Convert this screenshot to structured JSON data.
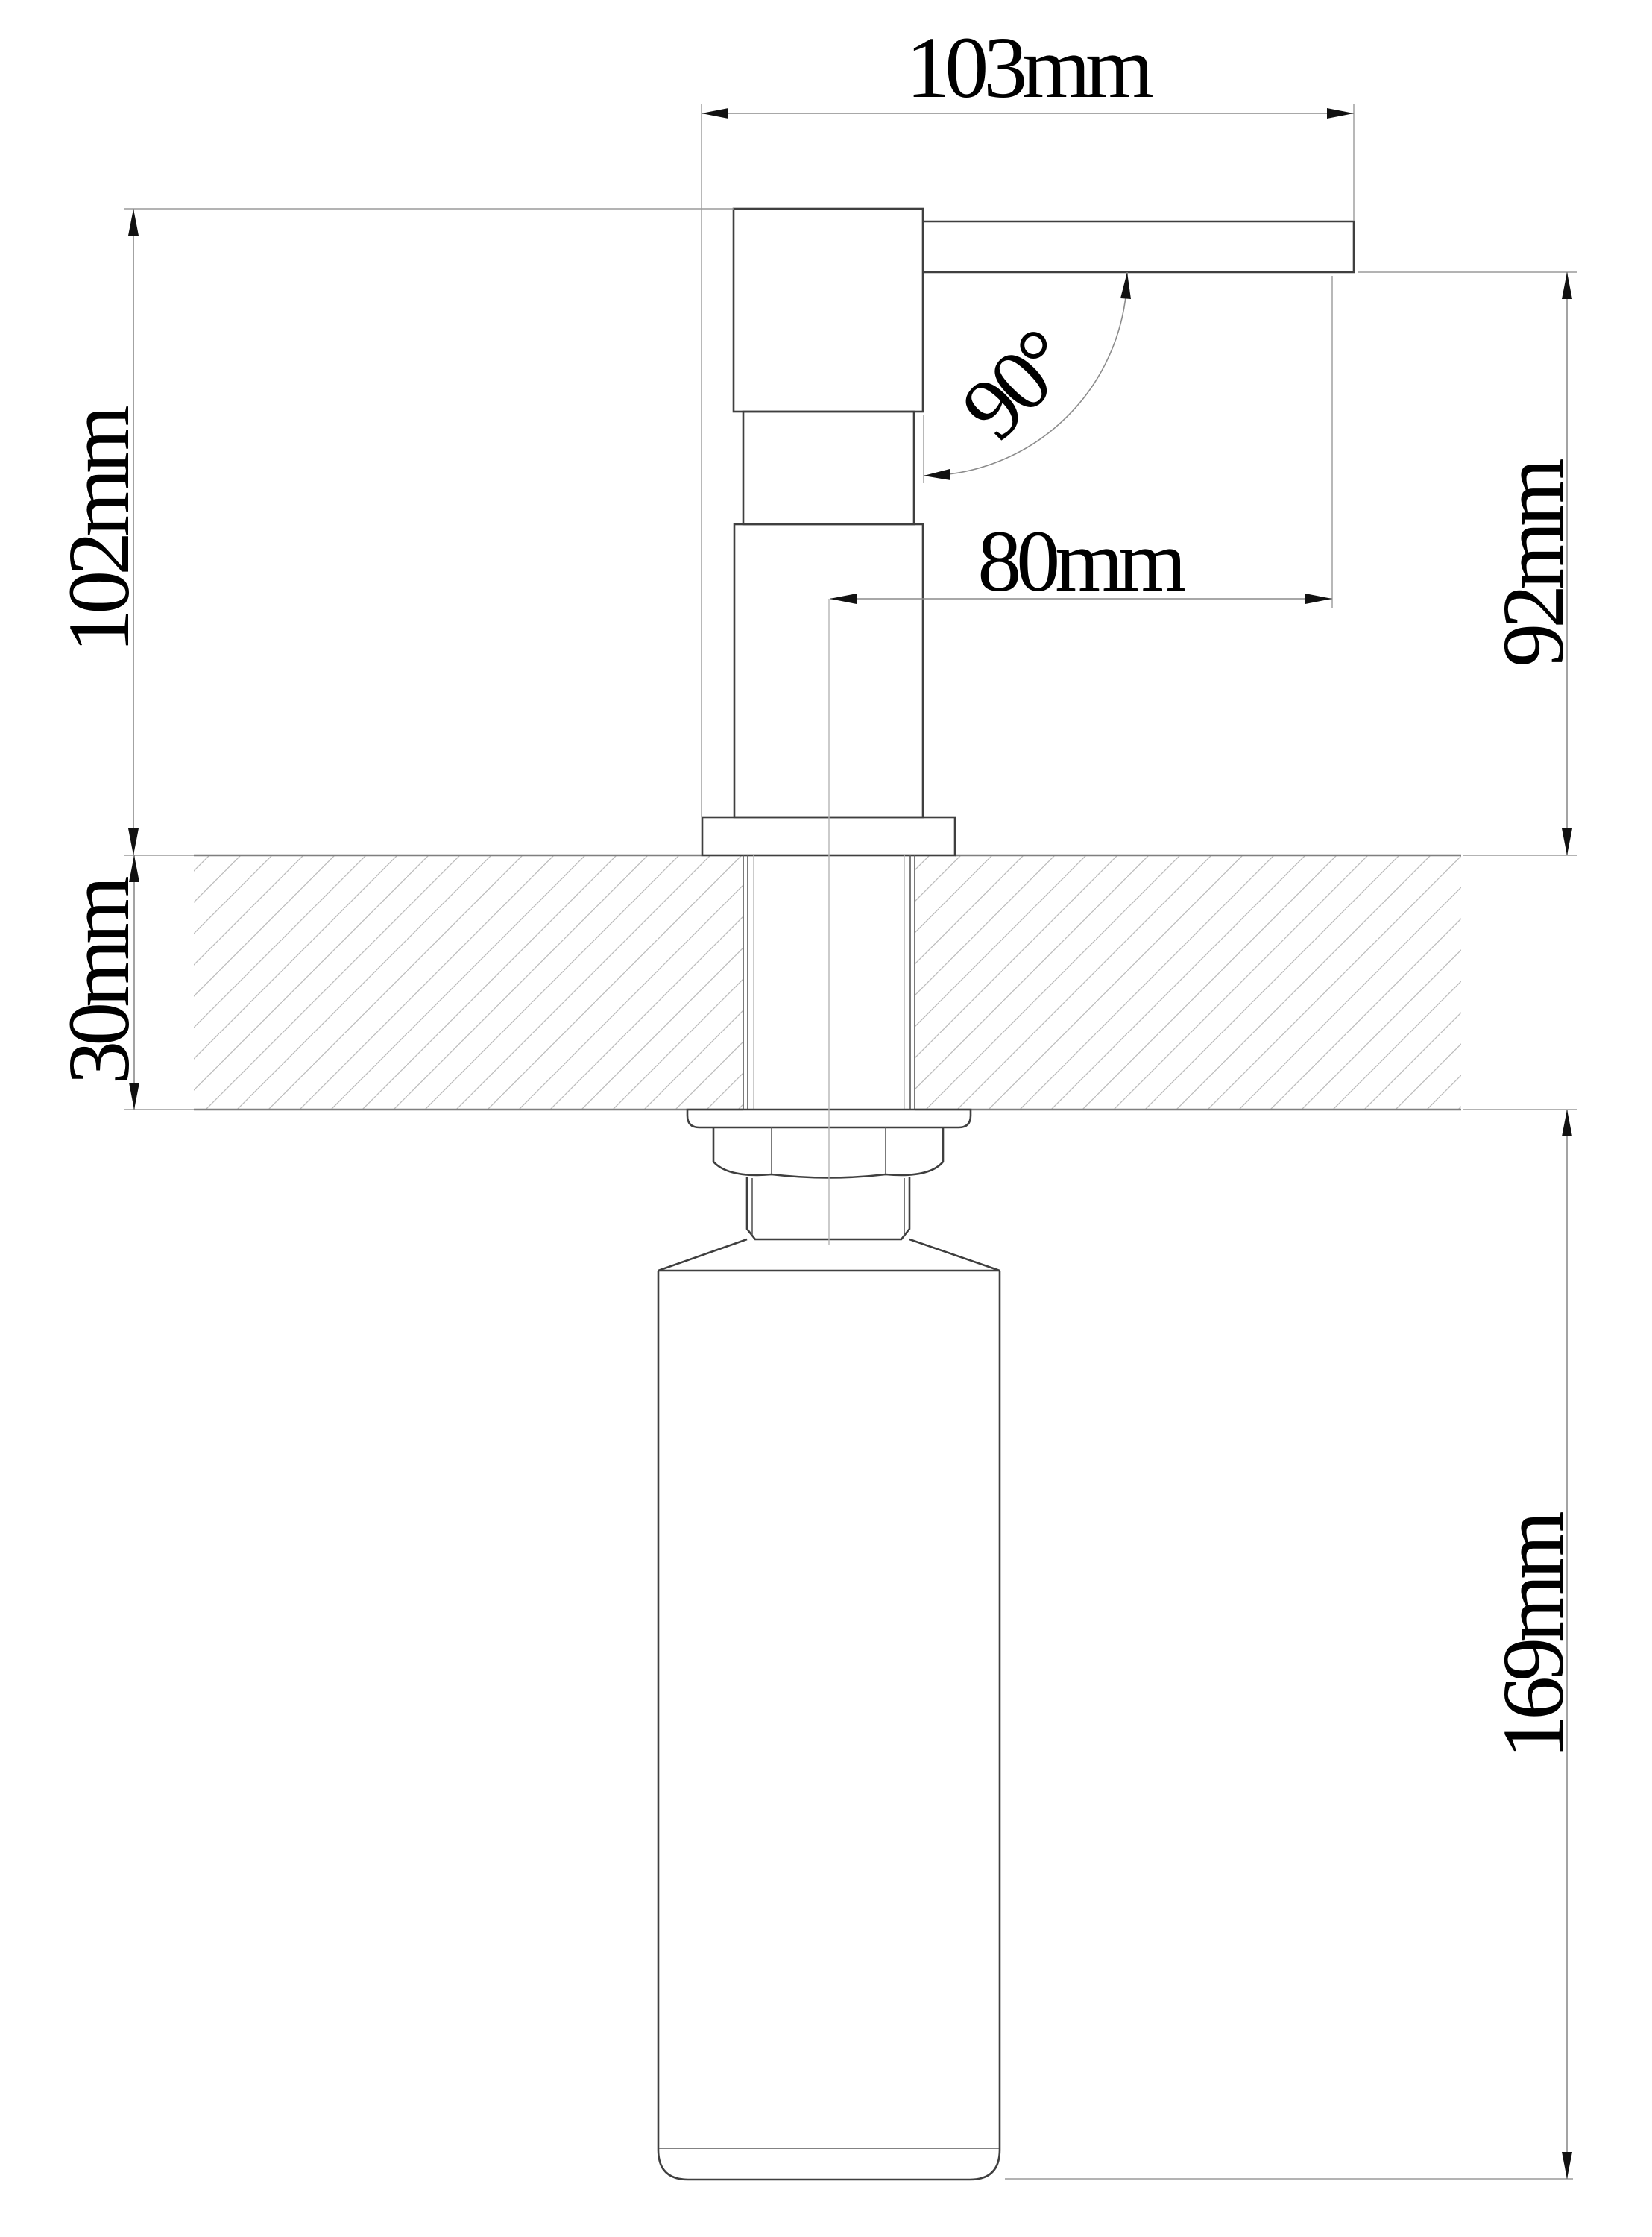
{
  "drawing": {
    "labels": {
      "top_width": "103mm",
      "height_above_counter": "102mm",
      "spout_angle": "90°",
      "spout_reach": "80mm",
      "spout_clearance": "92mm",
      "counter_thickness": "30mm",
      "bottle_height": "169mm"
    },
    "colors": {
      "background": "#ffffff",
      "object_outline": "#3f3f3f",
      "counter_edge": "#7f7f7f",
      "hatch": "#bcbcbc",
      "dimension_line": "#8c8c8c",
      "text": "#000000"
    }
  }
}
